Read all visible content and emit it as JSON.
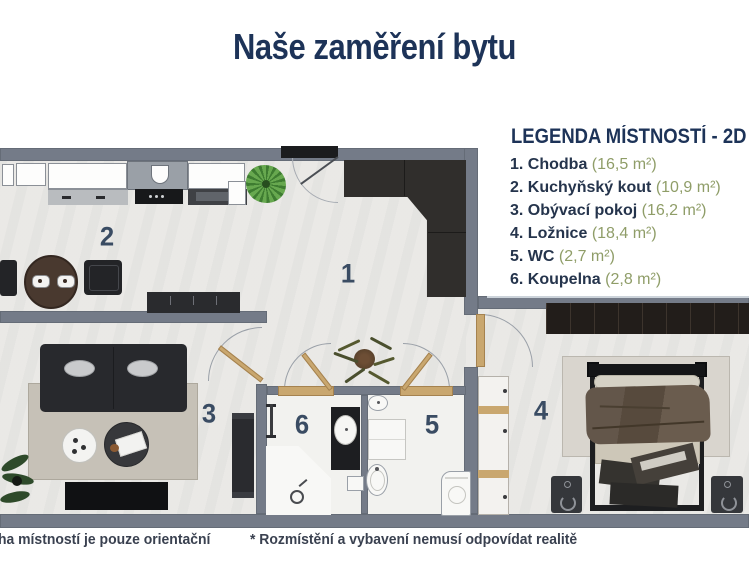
{
  "title": "Naše zaměření bytu",
  "legend": {
    "heading": "LEGENDA MÍSTNOSTÍ - 2D",
    "items": [
      {
        "label": "1. Chodba",
        "area": "(16,5 m²)"
      },
      {
        "label": "2. Kuchyňský kout",
        "area": "(10,9 m²)"
      },
      {
        "label": "3. Obývací pokoj",
        "area": "(16,2 m²)"
      },
      {
        "label": "4. Ložnice",
        "area": "(18,4 m²)"
      },
      {
        "label": "5. WC",
        "area": "(2,7 m²)"
      },
      {
        "label": "6. Koupelna",
        "area": "(2,8 m²)"
      }
    ]
  },
  "plan": {
    "labels": {
      "hallway": "1",
      "kitchen": "2",
      "living": "3",
      "bedroom": "4",
      "wc": "5",
      "bathroom": "6"
    }
  },
  "footnotes": {
    "left": "ha místností je pouze orientační",
    "right": "* Rozmístění a vybavení nemusí odpovídat realitě"
  },
  "colors": {
    "navy": "#1d3358",
    "sage": "#8f9d68",
    "wall": "#747b88"
  }
}
